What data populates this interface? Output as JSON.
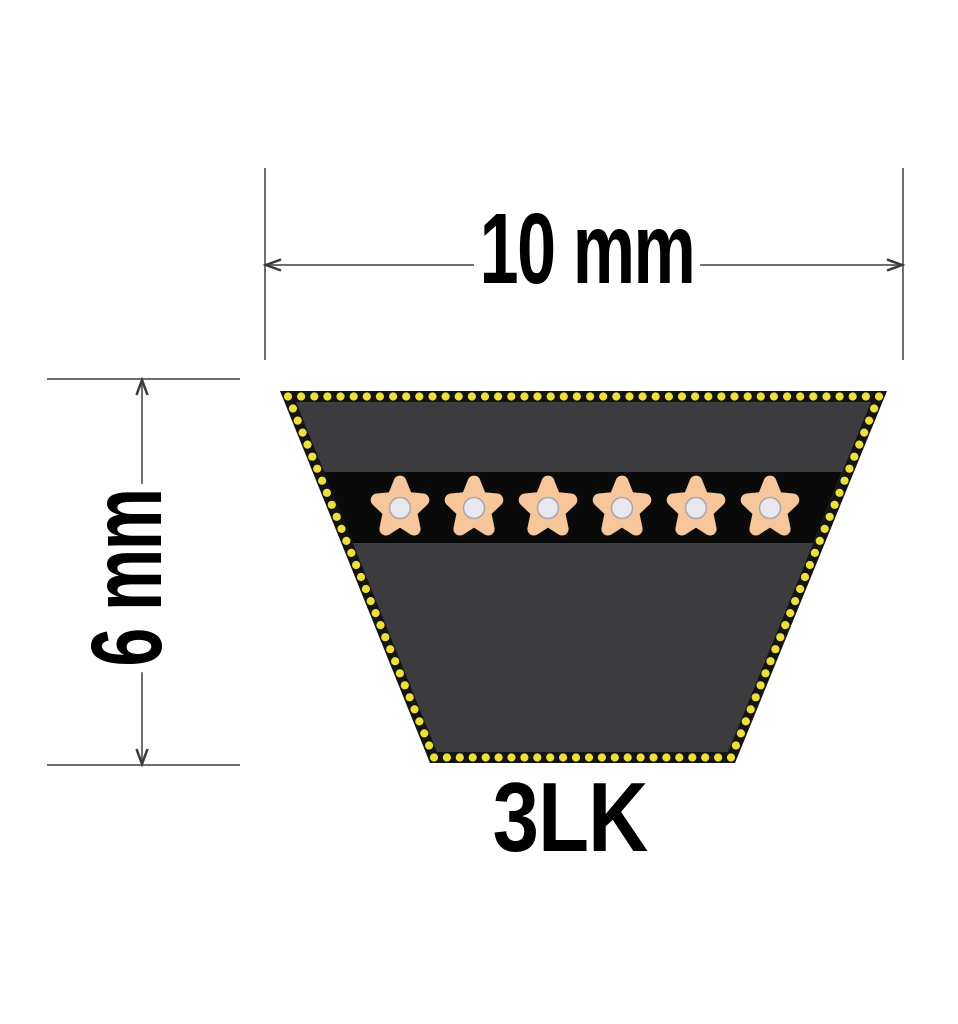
{
  "diagram": {
    "top_dimension_label": "10 mm",
    "left_dimension_label": "6 mm",
    "belt_designation": "3LK",
    "cord_count": 6,
    "colors": {
      "background": "#FFFFFF",
      "belt_border": "#141414",
      "belt_body": "#3C3C3E",
      "cord_band": "#0A0A0A",
      "border_dots": "#EDDF3C",
      "cord_star": "#F7C69B",
      "cord_core_fill": "#E7E7ED",
      "cord_core_ring": "#A6A6B2",
      "dimension_line": "#6E6E6E",
      "arrowhead": "#3A3A3A",
      "label_text": "#000000"
    }
  }
}
